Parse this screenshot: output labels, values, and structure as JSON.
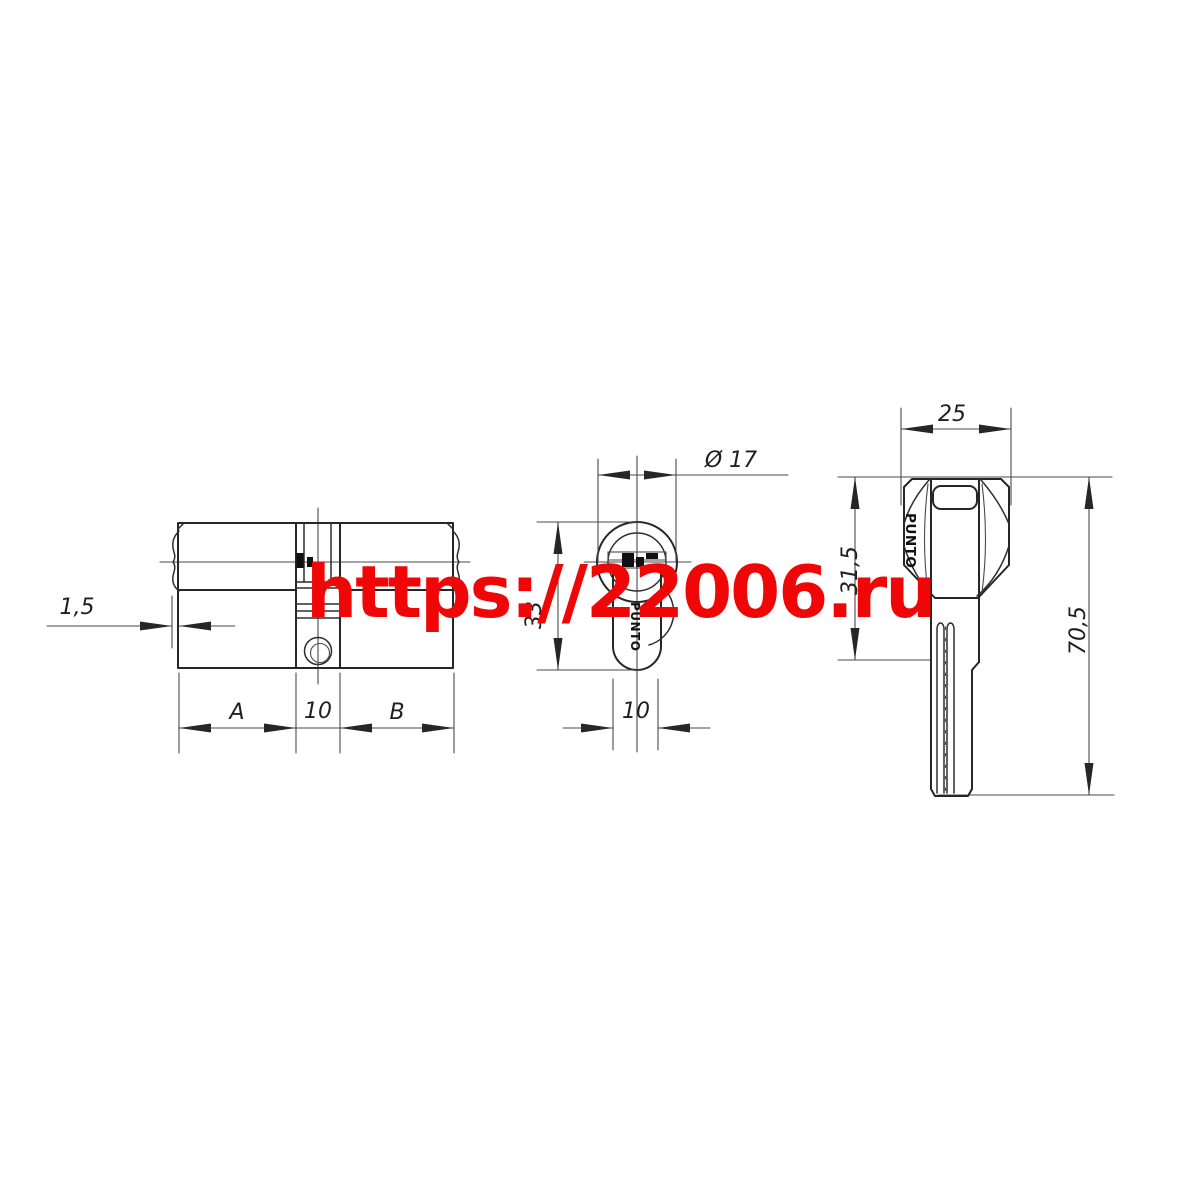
{
  "watermark": {
    "text": "https://22006.ru",
    "color": "#f00606"
  },
  "side_view": {
    "dim_cap": "1,5",
    "dim_a": "A",
    "dim_center": "10",
    "dim_b": "B"
  },
  "end_view": {
    "dim_diameter": "Ø 17",
    "dim_height": "33",
    "dim_width": "10",
    "brand": "PUNTO"
  },
  "key_view": {
    "dim_head_width": "25",
    "dim_head_length": "31,5",
    "dim_total_length": "70,5",
    "brand": "PUNTO"
  },
  "colors": {
    "line": "#262626",
    "watermark": "#f00606"
  }
}
